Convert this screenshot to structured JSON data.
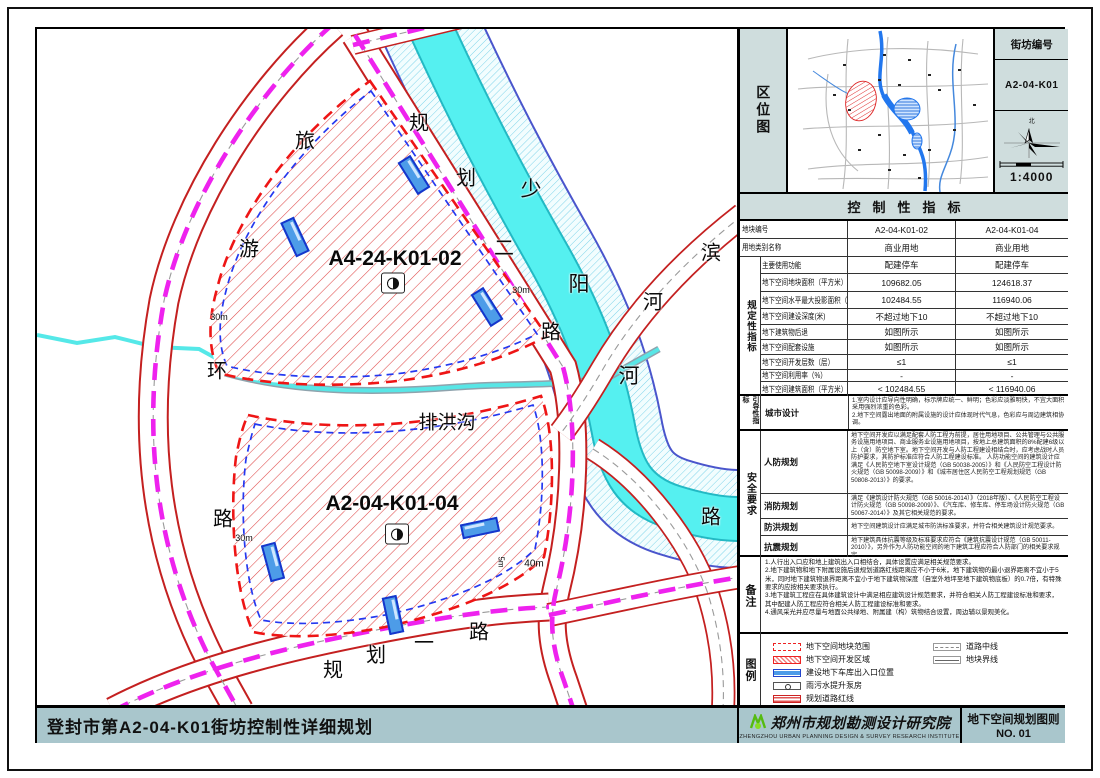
{
  "location_panel": {
    "side_label": "区位图",
    "block_no_label": "街坊编号",
    "block_no": "A2-04-K01",
    "north_label": "北",
    "scale": "1:4000"
  },
  "indicators": {
    "header": "控制性指标",
    "group_regulatory": "规定性指标",
    "rows": [
      {
        "label": "地块编号",
        "v1": "A2-04-K01-02",
        "v2": "A2-04-K01-04",
        "grouped": false
      },
      {
        "label": "用地类别名称",
        "v1": "商业用地",
        "v2": "商业用地",
        "grouped": false
      },
      {
        "label": "主要使用功能",
        "v1": "配建停车",
        "v2": "配建停车",
        "grouped": true
      },
      {
        "label": "地下空间地块面积（平方米）",
        "v1": "109682.05",
        "v2": "124618.37",
        "grouped": true
      },
      {
        "label": "地下空间水平最大投影面积（平方米）",
        "v1": "102484.55",
        "v2": "116940.06",
        "grouped": true
      },
      {
        "label": "地下空间建设深度(米)",
        "v1": "不超过地下10",
        "v2": "不超过地下10",
        "grouped": true
      },
      {
        "label": "地下建筑物后退",
        "v1": "如图所示",
        "v2": "如图所示",
        "grouped": true
      },
      {
        "label": "地下空间配套设施",
        "v1": "如图所示",
        "v2": "如图所示",
        "grouped": true
      },
      {
        "label": "地下空间开发层数（层）",
        "v1": "≤1",
        "v2": "≤1",
        "grouped": true
      },
      {
        "label": "地下空间利用率（%）",
        "v1": "-",
        "v2": "-",
        "grouped": true
      },
      {
        "label": "地下空间建筑面积（平方米）",
        "v1": "< 102484.55",
        "v2": "< 116940.06",
        "grouped": true
      }
    ],
    "guide": {
      "group": "引导性指标",
      "label": "城市设计",
      "text1": "1.室内设计应导向性明确，标示牌应统一、鲜明；色彩应淡雅明快，不宜大面积采用强烈浓重的色彩。",
      "text2": "2.地下空间露出地面的附属设施的设计应体现时代气息，色彩应与周边建筑相协调。"
    },
    "safety": {
      "group": "安全要求",
      "rows": [
        {
          "label": "人防规划",
          "text": "地下空间开发应以满足配套人防工程为前提，居住用地项目、公共管理与公共服务设施用地项目、商业服务业设施用地项目，按地上总建筑面积的8%配建6级以上（含）防空地下室。地下空间开发与人防工程建设相结合时，应考虑战时人员防护要求，其防护标准应符合人防工程建设标准。 人防功能空间的建筑设计应满足《人民防空地下室设计规范（GB 50038-2005）》和《人民防空工程设计防火规范（GB 50098-2009）》和《城市居住区人民防空工程规划规范（GB 50808-2013）》的要求。"
        },
        {
          "label": "消防规划",
          "text": "满足《建筑设计防火规范（GB 50016-2014）》（2018年版）、《人民防空工程设计防火规范（GB 50098-2009）》、《汽车库、修车库、停车场设计防火规范（GB 50067-2014）》及其它相关规范的要求。"
        },
        {
          "label": "防洪规划",
          "text": "地下空间建筑设计应满足城市防洪标准要求，并符合相关建筑设计规范要求。"
        },
        {
          "label": "抗震规划",
          "text": "地下建筑具体抗震等级及标准要求应符合《建筑抗震设计规范（GB 50011-2010）》，另外作为人防功能空间的地下建筑工程应符合人防部门的相关要求规定。"
        }
      ]
    }
  },
  "notes": {
    "group": "备注",
    "items": [
      "1.人行出入口应和地上建筑出入口相结合，具体设置应满足相关规范要求。",
      "2.地下建筑物和地下附属设施后退规划道路红线距离应不小于6米，地下建筑物的最小退界距离不宜小于5米，同时地下建筑物退界距离不宜小于地下建筑物深度（自室外地坪至地下建筑物底板）的0.7倍，有特殊要求的应按相关要求执行。",
      "3.地下建筑工程应在具体建筑设计中满足相应建筑设计规范要求，并符合相关人防工程建设标准和要求，其中配建人防工程应符合相关人防工程建设标准和要求。",
      "4.通风采光井应尽量与地面公共绿地、附属建（构）筑物结合设置，周边辅以景观美化。"
    ]
  },
  "legend": {
    "group": "图例",
    "items_left": [
      {
        "label": "地下空间地块范围"
      },
      {
        "label": "地下空间开发区域"
      },
      {
        "label": "建设地下车库出入口位置"
      },
      {
        "label": "雨污水提升泵房"
      },
      {
        "label": "规划道路红线"
      }
    ],
    "items_right": [
      {
        "label": "道路中线"
      },
      {
        "label": "地块界线"
      }
    ]
  },
  "titlebar": {
    "title": "登封市第A2-04-K01街坊控制性详细规划",
    "institute": "郑州市规划勘测设计研究院",
    "institute_en": "ZHENGZHOU URBAN PLANNING DESIGN & SURVEY RESEARCH INSTITUTE",
    "sheet_name": "地下空间规划图则",
    "sheet_no": "NO. 01"
  },
  "map": {
    "labels": [
      {
        "t": "旅",
        "x": 268,
        "y": 110,
        "s": 20,
        "n": "road-label-lvyouhuanlu"
      },
      {
        "t": "游",
        "x": 212,
        "y": 218,
        "s": 20,
        "n": "road-label-lvyouhuanlu"
      },
      {
        "t": "环",
        "x": 180,
        "y": 340,
        "s": 20,
        "n": "road-label-lvyouhuanlu"
      },
      {
        "t": "路",
        "x": 186,
        "y": 488,
        "s": 20,
        "n": "road-label-lvyouhuanlu"
      },
      {
        "t": "规",
        "x": 382,
        "y": 92,
        "s": 20,
        "n": "road-label-guihua2lu"
      },
      {
        "t": "划",
        "x": 429,
        "y": 147,
        "s": 20,
        "n": "road-label-guihua2lu"
      },
      {
        "t": "二",
        "x": 467,
        "y": 217,
        "s": 20,
        "n": "road-label-guihua2lu"
      },
      {
        "t": "路",
        "x": 514,
        "y": 301,
        "s": 20,
        "n": "road-label-guihua2lu"
      },
      {
        "t": "少",
        "x": 494,
        "y": 159,
        "s": 21,
        "n": "river-label-shaoyanghe"
      },
      {
        "t": "阳",
        "x": 542,
        "y": 254,
        "s": 21,
        "n": "river-label-shaoyanghe"
      },
      {
        "t": "河",
        "x": 592,
        "y": 346,
        "s": 21,
        "n": "river-label-shaoyanghe"
      },
      {
        "t": "滨",
        "x": 674,
        "y": 222,
        "s": 20,
        "n": "road-label-binhelu"
      },
      {
        "t": "河",
        "x": 616,
        "y": 271,
        "s": 20,
        "n": "road-label-binhelu"
      },
      {
        "t": "路",
        "x": 674,
        "y": 486,
        "s": 20,
        "n": "road-label-binhelu"
      },
      {
        "t": "排洪沟",
        "x": 410,
        "y": 392,
        "s": 19,
        "n": "channel-label-paihonggou"
      },
      {
        "t": "规",
        "x": 296,
        "y": 639,
        "s": 20,
        "n": "road-label-guihua1lu"
      },
      {
        "t": "划",
        "x": 339,
        "y": 624,
        "s": 20,
        "n": "road-label-guihua1lu"
      },
      {
        "t": "一",
        "x": 387,
        "y": 612,
        "s": 20,
        "n": "road-label-guihua1lu"
      },
      {
        "t": "路",
        "x": 442,
        "y": 601,
        "s": 20,
        "n": "road-label-guihua1lu"
      },
      {
        "t": "A4-24-K01-02",
        "x": 358,
        "y": 230,
        "s": 21,
        "b": true,
        "n": "parcel-code-label"
      },
      {
        "t": "A2-04-K01-04",
        "x": 355,
        "y": 475,
        "s": 21,
        "b": true,
        "n": "parcel-code-label"
      },
      {
        "t": "30m",
        "x": 182,
        "y": 288,
        "s": 9,
        "n": "dimension-label"
      },
      {
        "t": "30m",
        "x": 207,
        "y": 509,
        "s": 9,
        "n": "dimension-label"
      },
      {
        "t": "30m",
        "x": 484,
        "y": 261,
        "s": 9,
        "n": "dimension-label"
      },
      {
        "t": "40m",
        "x": 497,
        "y": 535,
        "s": 10,
        "n": "dimension-label"
      },
      {
        "t": "5m",
        "x": 464,
        "y": 533,
        "s": 8,
        "r": 90,
        "n": "dimension-label"
      }
    ],
    "markers": [
      {
        "type": "garage",
        "x": 377,
        "y": 146,
        "r": 58
      },
      {
        "type": "garage",
        "x": 258,
        "y": 208,
        "r": 65
      },
      {
        "type": "garage",
        "x": 450,
        "y": 278,
        "r": 58
      },
      {
        "type": "garage",
        "x": 443,
        "y": 499,
        "r": -12
      },
      {
        "type": "garage",
        "x": 356,
        "y": 586,
        "r": 78
      },
      {
        "type": "garage",
        "x": 236,
        "y": 533,
        "r": 75
      },
      {
        "type": "pump",
        "x": 356,
        "y": 254
      },
      {
        "type": "pump",
        "x": 360,
        "y": 505
      }
    ]
  },
  "colors": {
    "parcel_hatch_red": "#e04848",
    "parcel_boundary_red": "#ee1515",
    "parcel_boundary_blue": "#2438f0",
    "road_edge_red": "#c42020",
    "road_centerline_magenta": "#ee22ee",
    "river_cyan": "#55f0f0",
    "river_edge_blue": "#4a55cc",
    "panel_header_bg": "#cfdddd",
    "titlebar_bg": "#a9c6cc"
  }
}
